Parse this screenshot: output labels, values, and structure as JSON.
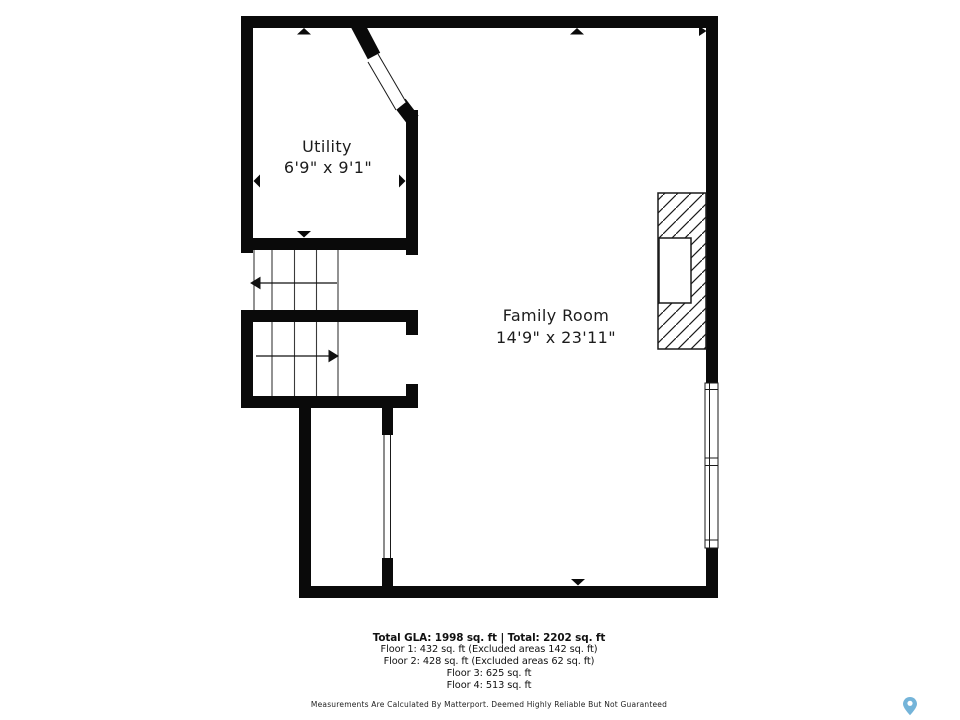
{
  "plan": {
    "rooms": [
      {
        "name": "Utility",
        "dimensions": "6'9\" x 9'1\""
      },
      {
        "name": "Family Room",
        "dimensions": "14'9\" x 23'11\""
      }
    ],
    "features": [
      "fireplace",
      "switchback-stairs",
      "windows"
    ]
  },
  "summary": {
    "total": "Total GLA: 1998 sq. ft | Total: 2202 sq. ft",
    "floors": [
      "Floor 1: 432 sq. ft (Excluded areas 142 sq. ft)",
      "Floor 2: 428 sq. ft (Excluded areas 62 sq. ft)",
      "Floor 3: 625 sq. ft",
      "Floor 4: 513 sq. ft"
    ]
  },
  "disclaimer": "Measurements Are Calculated By Matterport. Deemed Highly Reliable But Not Guaranteed",
  "icons": {
    "logo": "matterport-pin"
  },
  "colors": {
    "wall": "#0a0a0a",
    "text": "#1c1c1c",
    "logo_blue": "#74b4d9"
  }
}
